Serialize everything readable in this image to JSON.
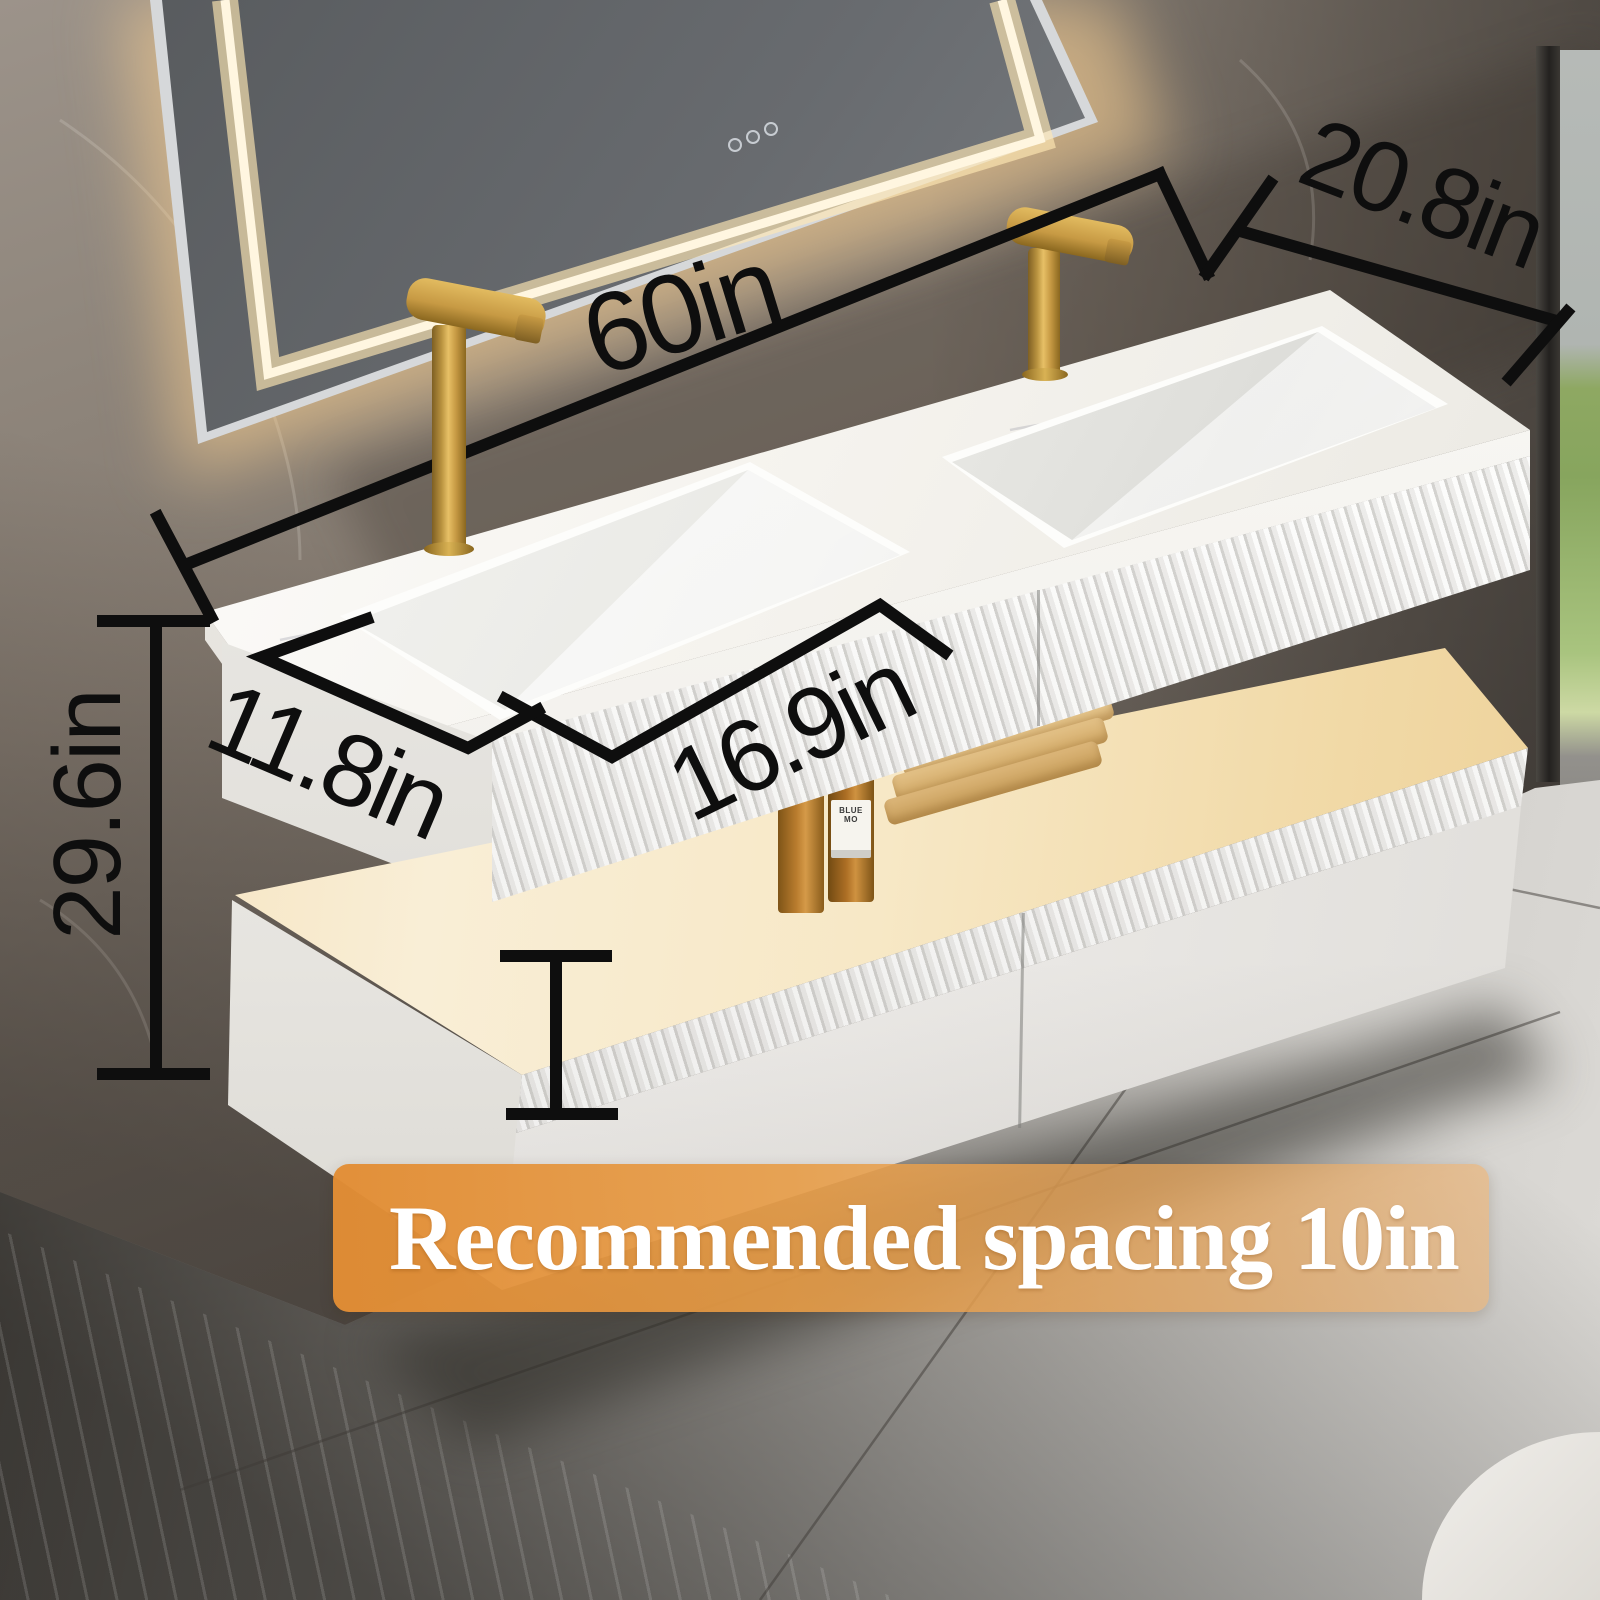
{
  "image": {
    "type": "product dimension photo",
    "subject": "wall-mounted double-sink floating bathroom vanity with LED mirror"
  },
  "dims": {
    "width": "60in",
    "depth_right": "20.8in",
    "sink_width": "16.9in",
    "depth_left": "11.8in",
    "height": "29.6in"
  },
  "banner": {
    "text": "Recommended spacing 10in"
  },
  "bottle": {
    "label": "BLUE MO"
  },
  "colors": {
    "dimension_line": "#0e0e0e",
    "banner_orange": "#e28d34",
    "banner_text": "#ffffff",
    "gold": "#c79a44",
    "led": "#fff6e0",
    "grass": "#87a55e",
    "shelf_warm": "#f5e2b8",
    "cabinet_white": "#f4f3f1",
    "counter_marble": "#f7f5f1"
  }
}
